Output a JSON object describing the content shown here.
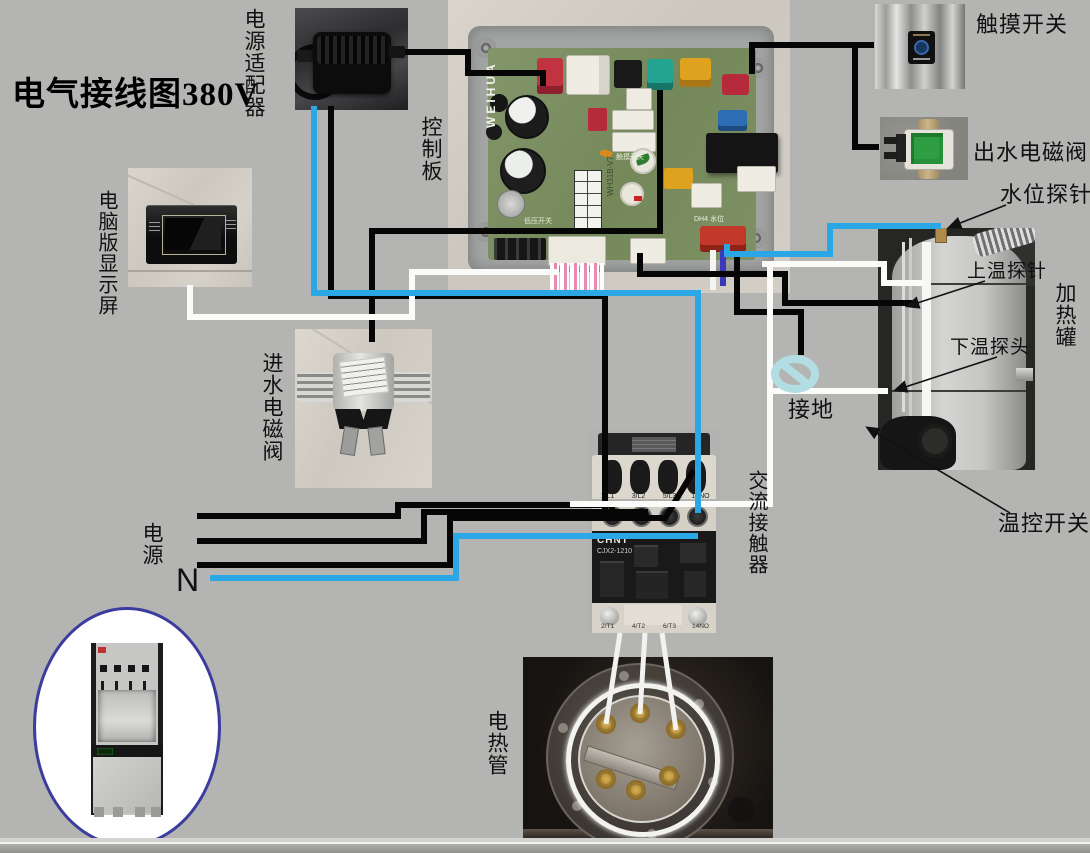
{
  "title": "电气接线图380V",
  "labels": {
    "power_adapter": "电源适配器",
    "control_board": "控制板",
    "display_screen": "电脑版显示屏",
    "inlet_valve": "进水电磁阀",
    "touch_switch": "触摸开关",
    "outlet_valve": "出水电磁阀",
    "water_level_probe": "水位探针",
    "upper_temp_probe": "上温探针",
    "heating_tank": "加热罐",
    "lower_temp_probe": "下温探头",
    "thermostat": "温控开关",
    "ground": "接地",
    "power": "电源",
    "neutral": "N",
    "ac_contactor": "交流接触器",
    "heating_tube": "电热管"
  },
  "control_board": {
    "brand": "WEIHUA",
    "model": "WH31B-V7",
    "silk_touch": "触摸开关",
    "silk_low_pressure": "低压开关",
    "silk_water_level": "DH4 水位"
  },
  "contactor": {
    "brand": "CHNT",
    "model": "CJX2-1210",
    "top_terminals": [
      "1/L1",
      "3/L2",
      "5/L3",
      "13NO"
    ],
    "bottom_terminals": [
      "2/T1",
      "4/T2",
      "6/T3",
      "14NO"
    ]
  },
  "colors": {
    "background": "#b4b4b2",
    "wire_black": "#0a0a0a",
    "wire_blue": "#2ba7e6",
    "wire_white": "#fbfbfa",
    "ground_symbol": "#b2dde2",
    "dispenser_ring": "#3c3c9e"
  }
}
